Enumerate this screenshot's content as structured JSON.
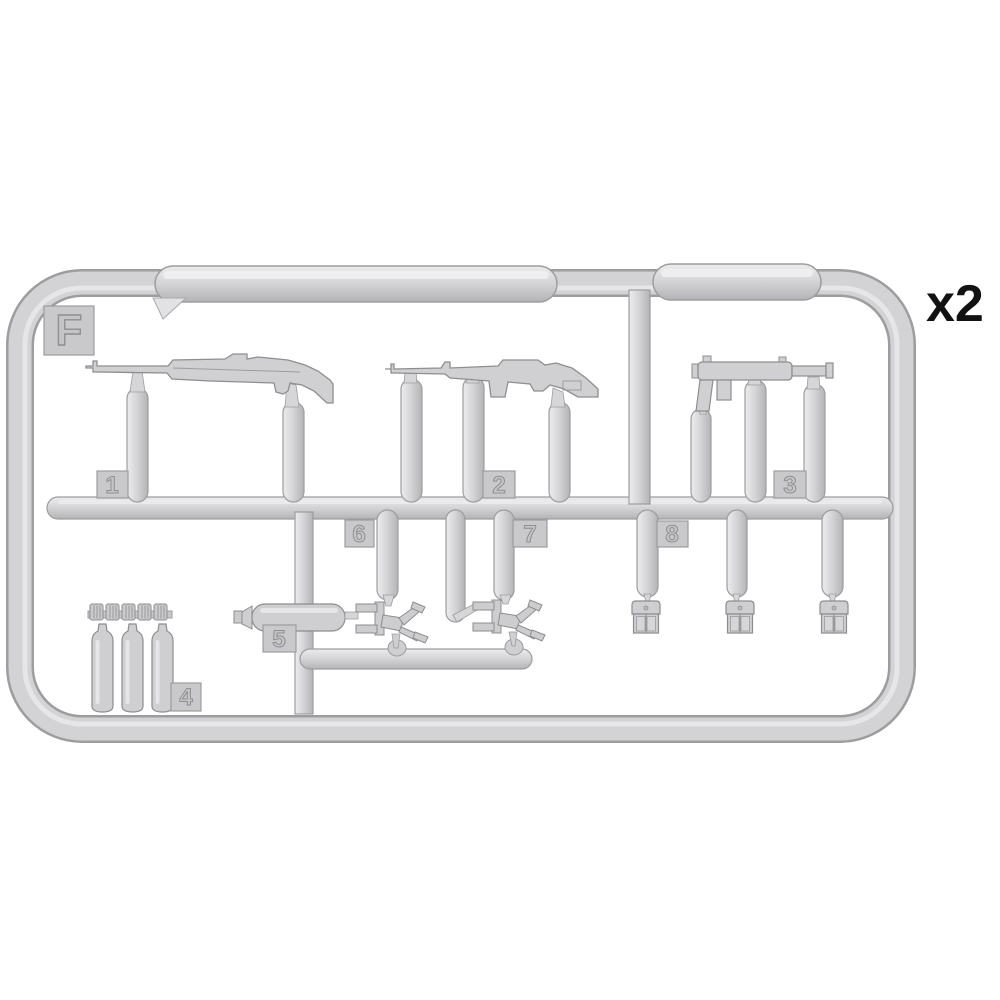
{
  "figure": {
    "kind": "model-kit-sprue-diagram",
    "sprue_letter": "F",
    "quantity_label": "x2",
    "background_color": "#ffffff",
    "plastic_color": "#d2d2d4",
    "plastic_highlight": "#ebebed",
    "plastic_shadow": "#b5b5b8",
    "outline_color": "#97979a",
    "label_ink": "#121212"
  },
  "parts": [
    {
      "number": "1",
      "name": "rifle-long"
    },
    {
      "number": "2",
      "name": "carbine"
    },
    {
      "number": "3",
      "name": "submachine-gun"
    },
    {
      "number": "4",
      "name": "water-bottles-and-caps"
    },
    {
      "number": "5",
      "name": "flask-cylinder"
    },
    {
      "number": "6",
      "name": "folding-mount-left"
    },
    {
      "number": "7",
      "name": "folding-mount-right"
    },
    {
      "number": "8",
      "name": "ammo-pouch-set"
    }
  ]
}
